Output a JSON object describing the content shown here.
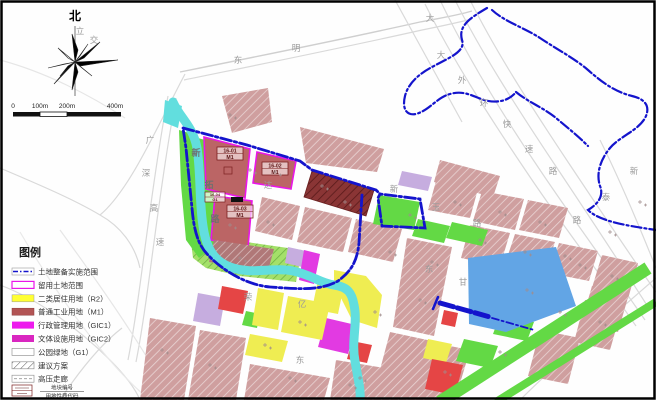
{
  "compass": {
    "north_label": "北"
  },
  "scale_bar": {
    "labels": [
      "0",
      "100m",
      "200m",
      "400m"
    ]
  },
  "legend": {
    "title": "图例",
    "items": [
      {
        "key": "implementation-scope",
        "label": "土地整备实施范围"
      },
      {
        "key": "retained-land",
        "label": "留用土地范围"
      },
      {
        "key": "residential-r2",
        "label": "二类居住用地（R2）"
      },
      {
        "key": "industrial-m1",
        "label": "普通工业用地（M1）"
      },
      {
        "key": "admin-gic1",
        "label": "行政管理用地（GIC1）"
      },
      {
        "key": "culture-gic2",
        "label": "文体设施用地（GIC2）"
      },
      {
        "key": "park-g1",
        "label": "公园绿地（G1）"
      },
      {
        "key": "proposal",
        "label": "建议方案"
      },
      {
        "key": "hv-corridor",
        "label": "高压走廊"
      }
    ],
    "code_symbol": {
      "top": "地块编号",
      "bottom": "用地性质代码"
    }
  },
  "map": {
    "parcel_labels": [
      {
        "code": "16-01",
        "use": "M1"
      },
      {
        "code": "16-02",
        "use": "M1"
      },
      {
        "code": "16-03",
        "use": "M1"
      },
      {
        "code": "16-04",
        "use": "G1"
      }
    ],
    "road_labels": [
      {
        "t": "东"
      },
      {
        "t": "明"
      },
      {
        "t": "大"
      },
      {
        "t": "大"
      },
      {
        "t": "外"
      },
      {
        "t": "环"
      },
      {
        "t": "快"
      },
      {
        "t": "速"
      },
      {
        "t": "路"
      },
      {
        "t": "新"
      },
      {
        "t": "泰"
      },
      {
        "t": "路"
      },
      {
        "t": "广"
      },
      {
        "t": "深"
      },
      {
        "t": "高"
      },
      {
        "t": "速"
      },
      {
        "t": "新"
      },
      {
        "t": "拓"
      },
      {
        "t": "路"
      },
      {
        "t": "达"
      },
      {
        "t": "新"
      },
      {
        "t": "玉"
      },
      {
        "t": "路"
      },
      {
        "t": "东"
      },
      {
        "t": "甘"
      },
      {
        "t": "东"
      },
      {
        "t": "荣"
      },
      {
        "t": "亿"
      },
      {
        "t": "立"
      },
      {
        "t": "交"
      }
    ]
  },
  "colors": {
    "boundary_blue": "#1414cc",
    "retained_border_magenta": "#e916e9",
    "residential_yellow": "#ffff33",
    "industrial_red": "#b25454",
    "gic1_magenta": "#ed1aed",
    "gic2_magenta": "#d926c0",
    "park_green": "#63d945",
    "river_cyan": "#62dede",
    "water_blue": "#62a5e5",
    "parcel_pink": "#cf9f9f"
  }
}
